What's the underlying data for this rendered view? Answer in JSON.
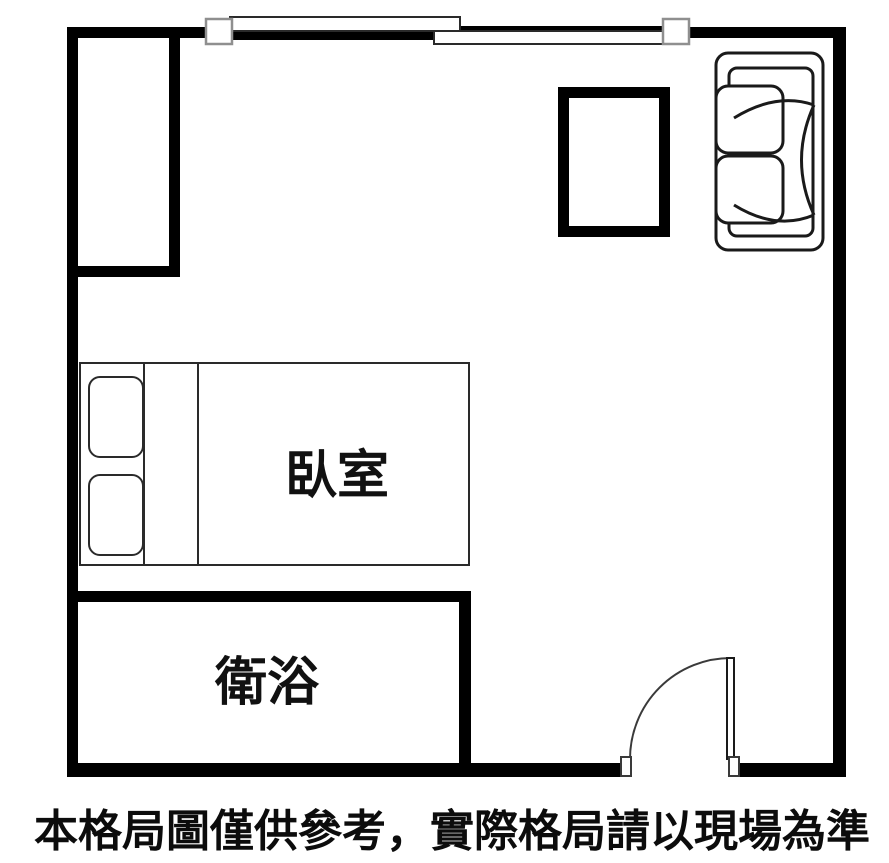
{
  "colors": {
    "background": "#ffffff",
    "wall": "#000000",
    "furniture_stroke": "#1a1a1a",
    "window_sash_stroke": "#8f8f8f",
    "text": "#0c0c0c"
  },
  "rooms": {
    "bedroom": {
      "label": "臥室"
    },
    "bathroom": {
      "label": "衛浴"
    }
  },
  "furniture": {
    "wardrobe": {
      "name": "wardrobe-closet"
    },
    "bed": {
      "name": "double-bed",
      "pillows": 2
    },
    "tv_cabinet": {
      "name": "tv-cabinet"
    },
    "sofa": {
      "name": "sofa",
      "cushions": 2
    },
    "window": {
      "name": "sliding-window",
      "panes": 2
    },
    "door": {
      "name": "entry-door",
      "swing": "quarter-arc"
    }
  },
  "caption": {
    "text": "本格局圖僅供參考，實際格局請以現場為準"
  }
}
